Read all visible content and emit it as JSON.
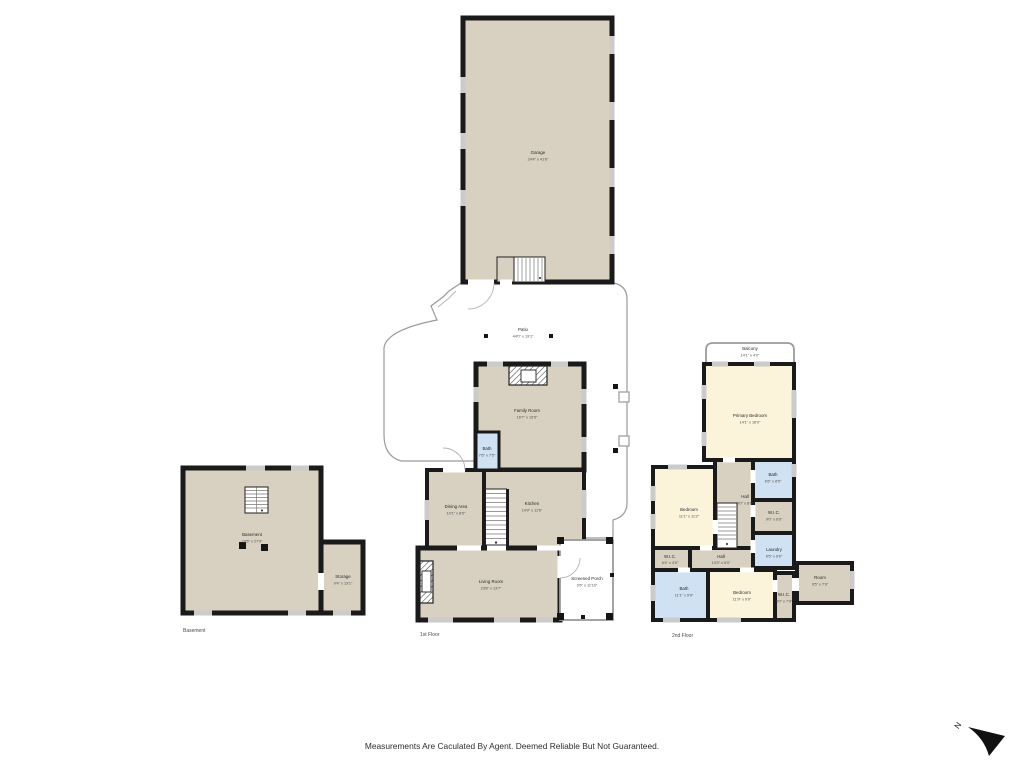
{
  "colors": {
    "floor_tan": "#d8d0c0",
    "room_cream": "#fbf4da",
    "room_blue": "#cfe1f3",
    "wall": "#1a1a1a",
    "window_gray": "#cbcbcb"
  },
  "footer": {
    "disclaimer": "Measurements Are Caculated By Agent. Deemed Reliable But Not Guaranteed.",
    "north_label": "N"
  },
  "floor_labels": {
    "basement": "Basement",
    "first": "1st Floor",
    "second": "2nd Floor"
  },
  "rooms": {
    "garage": {
      "name": "Garage",
      "dims": "24'4\" x 41'6\""
    },
    "patio": {
      "name": "Patio",
      "dims": "44'0\" x 19'1\""
    },
    "family_room": {
      "name": "Family Room",
      "dims": "16'7\" x 19'5\""
    },
    "bath_first": {
      "name": "Bath",
      "dims": "7'6\" x 7'5\""
    },
    "dining_area": {
      "name": "Dining Area",
      "dims": "10'1\" x 8'5\""
    },
    "kitchen": {
      "name": "Kitchen",
      "dims": "14'9\" x 11'6\""
    },
    "living_room": {
      "name": "Living Room",
      "dims": "23'8\" x 13'7\""
    },
    "screened_porch": {
      "name": "Screened Porch",
      "dims": "9'6\" x 11'10\""
    },
    "basement": {
      "name": "Basement",
      "dims": "23'6\" x 27'9\""
    },
    "storage": {
      "name": "Storage",
      "dims": "9'4\" x 13'1\""
    },
    "balcony": {
      "name": "Balcony",
      "dims": "14'1\" x 4'0\""
    },
    "primary_bedroom": {
      "name": "Primary Bedroom",
      "dims": "14'1\" x 16'0\""
    },
    "bath_upper": {
      "name": "Bath",
      "dims": "6'6\" x 8'5\""
    },
    "bedroom_left": {
      "name": "Bedroom",
      "dims": "11'1\" x 11'2\""
    },
    "hall_upper": {
      "name": "Hall",
      "dims": "3'0\" x 6'8\""
    },
    "wic_right": {
      "name": "W.I.C.",
      "dims": "9'0\" x 6'6\""
    },
    "laundry": {
      "name": "Laundry",
      "dims": "6'5\" x 6'6\""
    },
    "wic_left": {
      "name": "W.I.C.",
      "dims": "6'4\" x 4'5\""
    },
    "hall_center": {
      "name": "Hall",
      "dims": "13'0\" x 6'0\""
    },
    "bath_lower": {
      "name": "Bath",
      "dims": "11'1\" x 9'9\""
    },
    "bedroom_lower": {
      "name": "Bedroom",
      "dims": "11'9\" x 9'9\""
    },
    "wic_lower": {
      "name": "W.I.C.",
      "dims": "4'0\" x 7'9\""
    },
    "room_side": {
      "name": "Room",
      "dims": "9'5\" x 7'9\""
    }
  }
}
